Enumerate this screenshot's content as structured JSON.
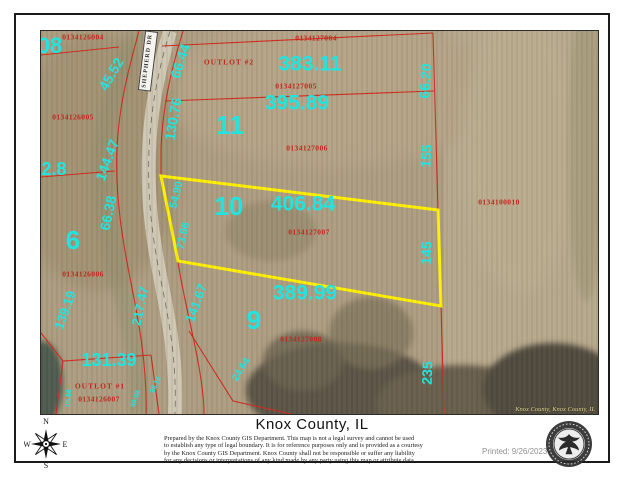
{
  "colors": {
    "label_cyan": "#22e4de",
    "parcel_line_red": "#c3261d",
    "highlight_yellow": "#ffef00",
    "road_gray": "#cdc6b2"
  },
  "map": {
    "road_label": "SHEPHERD DR",
    "imagery_credit": "Knox County, Knox County, IL",
    "lot_numbers": [
      {
        "text": "08",
        "x": 9,
        "y": 15,
        "size": 22
      },
      {
        "text": "5",
        "x": -12,
        "y": 51,
        "size": 26
      },
      {
        "text": "11",
        "x": 189,
        "y": 94,
        "size": 26
      },
      {
        "text": "10",
        "x": 188,
        "y": 175,
        "size": 26
      },
      {
        "text": "6",
        "x": 32,
        "y": 209,
        "size": 26
      },
      {
        "text": "9",
        "x": 213,
        "y": 289,
        "size": 26
      }
    ],
    "dimension_labels": [
      {
        "text": "383.11",
        "x": 269,
        "y": 33,
        "size": 21
      },
      {
        "text": "395.89",
        "x": 256,
        "y": 72,
        "size": 21
      },
      {
        "text": "406.84",
        "x": 262,
        "y": 173,
        "size": 21
      },
      {
        "text": "389.99",
        "x": 264,
        "y": 262,
        "size": 21
      },
      {
        "text": "131.39",
        "x": 68,
        "y": 329,
        "size": 18
      },
      {
        "text": "02.8",
        "x": 8,
        "y": 138,
        "size": 18
      }
    ],
    "rotated_dimension_labels": [
      {
        "text": "66.44",
        "x": 139,
        "y": 30,
        "rot": -72,
        "size": 14
      },
      {
        "text": "45.52",
        "x": 70,
        "y": 43,
        "rot": -60,
        "size": 14
      },
      {
        "text": "130.76",
        "x": 132,
        "y": 88,
        "rot": -80,
        "size": 14
      },
      {
        "text": "144.47",
        "x": 66,
        "y": 129,
        "rot": -70,
        "size": 14
      },
      {
        "text": "66.20",
        "x": 384,
        "y": 50,
        "rot": -86,
        "size": 14
      },
      {
        "text": "155",
        "x": 385,
        "y": 125,
        "rot": -86,
        "size": 14
      },
      {
        "text": "66.38",
        "x": 67,
        "y": 182,
        "rot": -78,
        "size": 14
      },
      {
        "text": "54.90",
        "x": 136,
        "y": 164,
        "rot": -76,
        "size": 11
      },
      {
        "text": "73.86",
        "x": 143,
        "y": 205,
        "rot": -78,
        "size": 11
      },
      {
        "text": "141.67",
        "x": 155,
        "y": 272,
        "rot": -70,
        "size": 13
      },
      {
        "text": "145",
        "x": 385,
        "y": 222,
        "rot": -88,
        "size": 14
      },
      {
        "text": "139.19",
        "x": 24,
        "y": 279,
        "rot": -70,
        "size": 13
      },
      {
        "text": "217.47",
        "x": 99,
        "y": 275,
        "rot": -78,
        "size": 13
      },
      {
        "text": "24.64",
        "x": 201,
        "y": 339,
        "rot": -58,
        "size": 10
      },
      {
        "text": "235",
        "x": 386,
        "y": 342,
        "rot": -88,
        "size": 14
      },
      {
        "text": "05.66",
        "x": 28,
        "y": 367,
        "rot": -85,
        "size": 7
      },
      {
        "text": "40.08",
        "x": 95,
        "y": 368,
        "rot": -70,
        "size": 7
      },
      {
        "text": "28.16",
        "x": 115,
        "y": 354,
        "rot": -65,
        "size": 7
      }
    ],
    "parcel_ids": [
      {
        "text": "0134126004",
        "x": 42,
        "y": 6
      },
      {
        "text": "0134127004",
        "x": 275,
        "y": 7
      },
      {
        "text": "0134127005",
        "x": 255,
        "y": 55
      },
      {
        "text": "0134127006",
        "x": 266,
        "y": 117
      },
      {
        "text": "0134127007",
        "x": 268,
        "y": 201
      },
      {
        "text": "0134100010",
        "x": 458,
        "y": 171
      },
      {
        "text": "0134126005",
        "x": 32,
        "y": 86
      },
      {
        "text": "0134126006",
        "x": 42,
        "y": 243
      },
      {
        "text": "0134126007",
        "x": 58,
        "y": 368
      },
      {
        "text": "0134127008",
        "x": 260,
        "y": 308
      }
    ],
    "outlot_labels": [
      {
        "text": "OUTLOT #2",
        "x": 188,
        "y": 31
      },
      {
        "text": "OUTLOT #1",
        "x": 59,
        "y": 355
      }
    ]
  },
  "footer": {
    "title": "Knox County, IL",
    "disclaimer_lines": [
      "Prepared by the Knox County GIS Department. This map is not a legal survey and cannot be used",
      "to establish any type of legal boundary. It is for reference purposes only and is provided as a courtesy",
      "by the Knox County GIS Department.  Knox County shall not be responsible or suffer any liability",
      "for any decisions or interpretations of any kind made by any party using this map or attribute data."
    ],
    "printed_label": "Printed: 9/26/2023"
  },
  "compass": {
    "n": "N",
    "e": "E",
    "s": "S",
    "w": "W"
  }
}
